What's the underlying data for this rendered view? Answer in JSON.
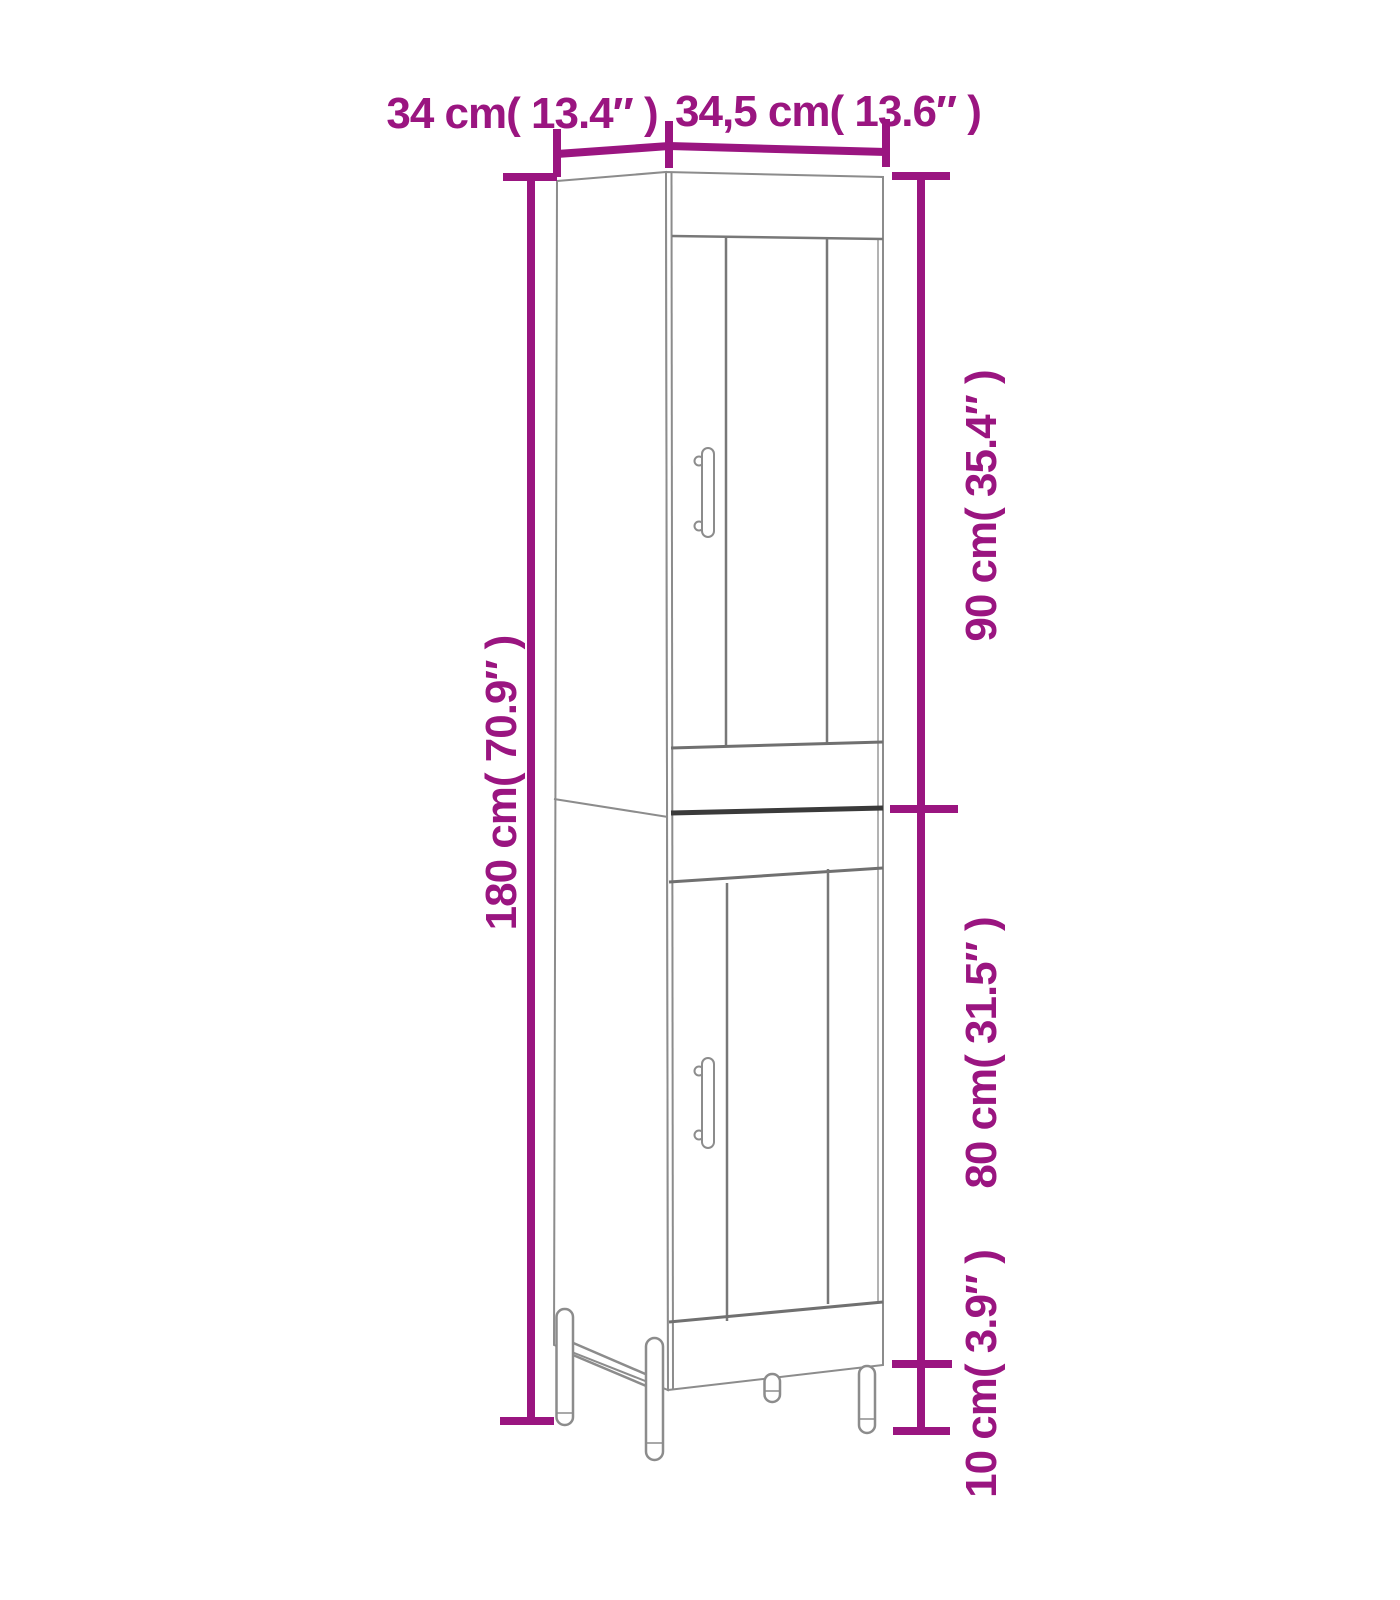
{
  "diagram": {
    "kind": "furniture-dimension-diagram",
    "dimension_labels": {
      "depth": "34 cm( 13.4″ )",
      "width": "34,5 cm( 13.6″ )",
      "total_height": "180 cm( 70.9″ )",
      "upper_section_height": "90 cm( 35.4″ )",
      "lower_section_height": "80 cm( 31.5″ )",
      "leg_height": "10 cm( 3.9″ )"
    },
    "measurements": [
      {
        "part": "depth",
        "cm": "34",
        "inches": "13.4"
      },
      {
        "part": "width",
        "cm": "34,5",
        "inches": "13.6"
      },
      {
        "part": "total-height",
        "cm": "180",
        "inches": "70.9"
      },
      {
        "part": "upper-section-height",
        "cm": "90",
        "inches": "35.4"
      },
      {
        "part": "lower-section-height",
        "cm": "80",
        "inches": "31.5"
      },
      {
        "part": "leg-height",
        "cm": "10",
        "inches": "3.9"
      }
    ],
    "colors": {
      "dimension_accent": "#9A1580",
      "outline": "#8C8C8C",
      "outline_dark": "#3A3A3A",
      "background": "#FFFFFF"
    }
  }
}
